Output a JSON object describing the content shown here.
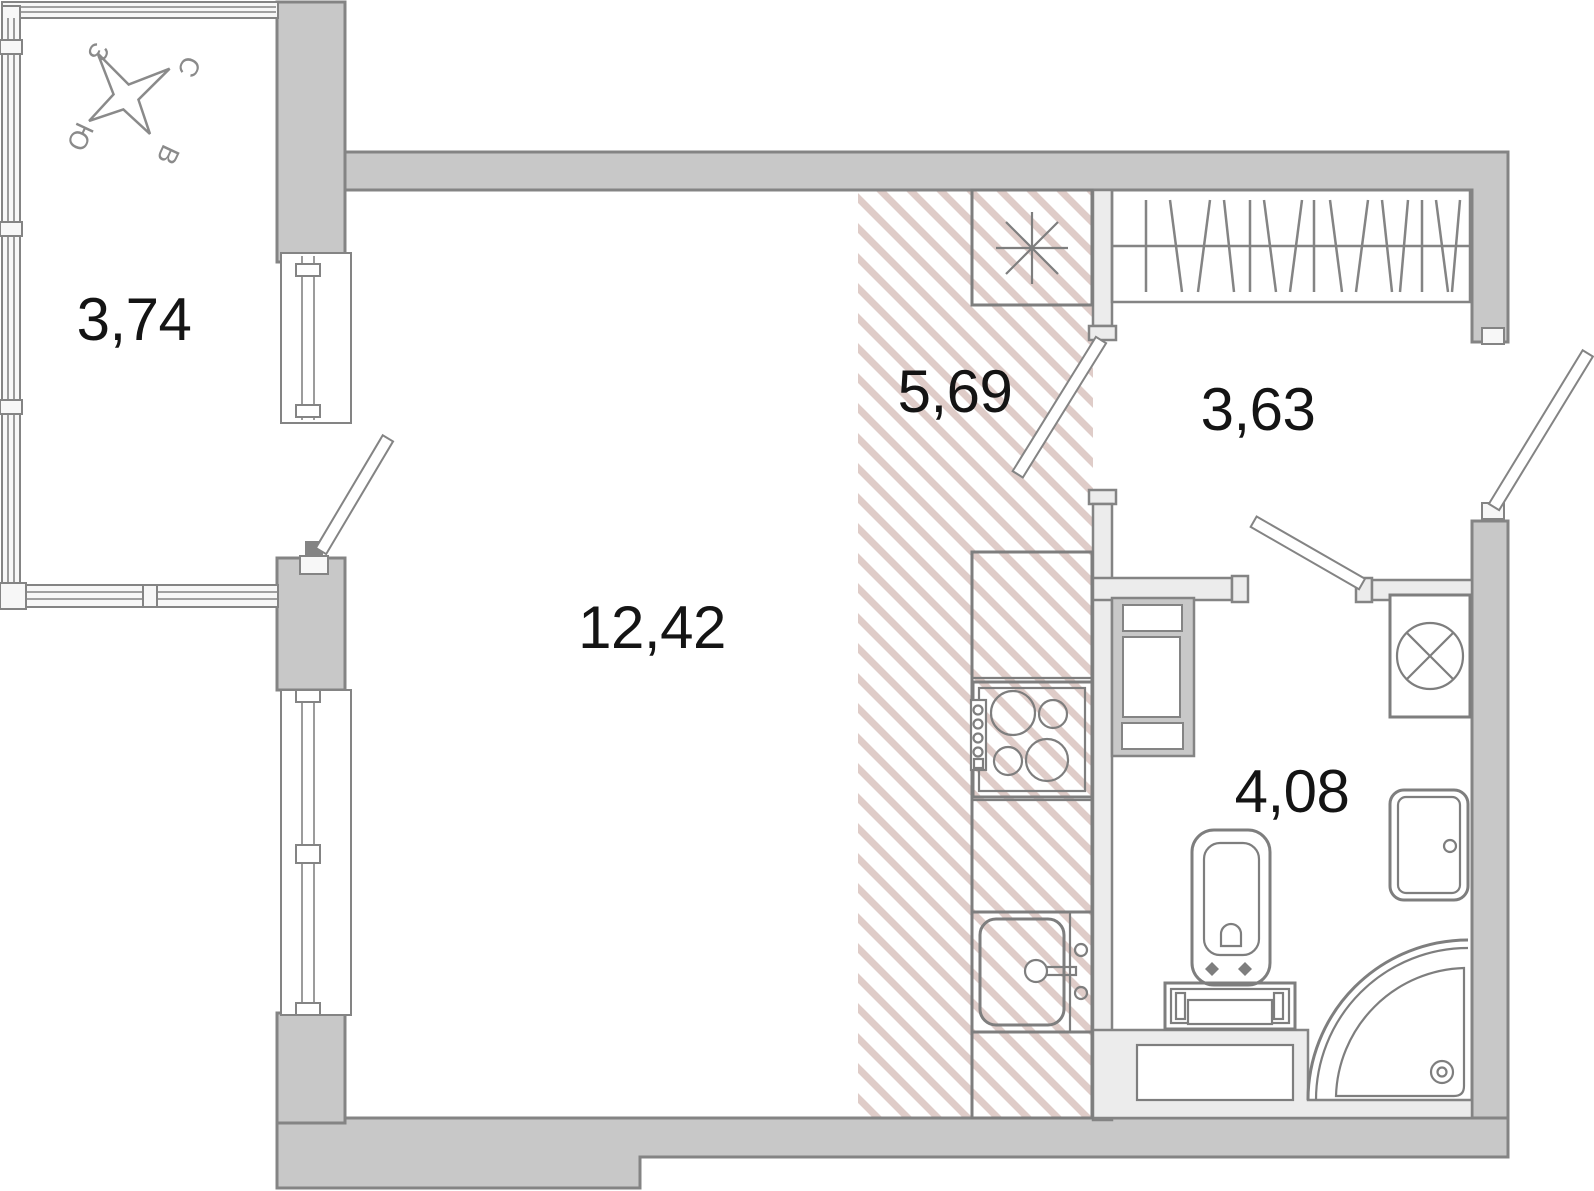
{
  "rooms": {
    "balcony": {
      "area": "3,74"
    },
    "living": {
      "area": "12,42"
    },
    "kitchen": {
      "area": "5,69"
    },
    "hallway": {
      "area": "3,63"
    },
    "bathroom": {
      "area": "4,08"
    }
  },
  "compass": {
    "north": "С",
    "east": "В",
    "south": "Ю",
    "west": "З"
  },
  "colors": {
    "wall": "#c8c8c8",
    "wallline": "#848484",
    "partition": "#ececec",
    "fixture": "#7e7e7e",
    "hatch": "#dfccc8",
    "text": "#141414",
    "compass": "#8a8a8a"
  },
  "icons": [
    "compass-rose",
    "wardrobe-icon",
    "fridge-icon",
    "stove-icon",
    "kitchen-sink-icon",
    "washing-machine-icon",
    "bathroom-sink-icon",
    "toilet-icon",
    "shower-icon"
  ]
}
